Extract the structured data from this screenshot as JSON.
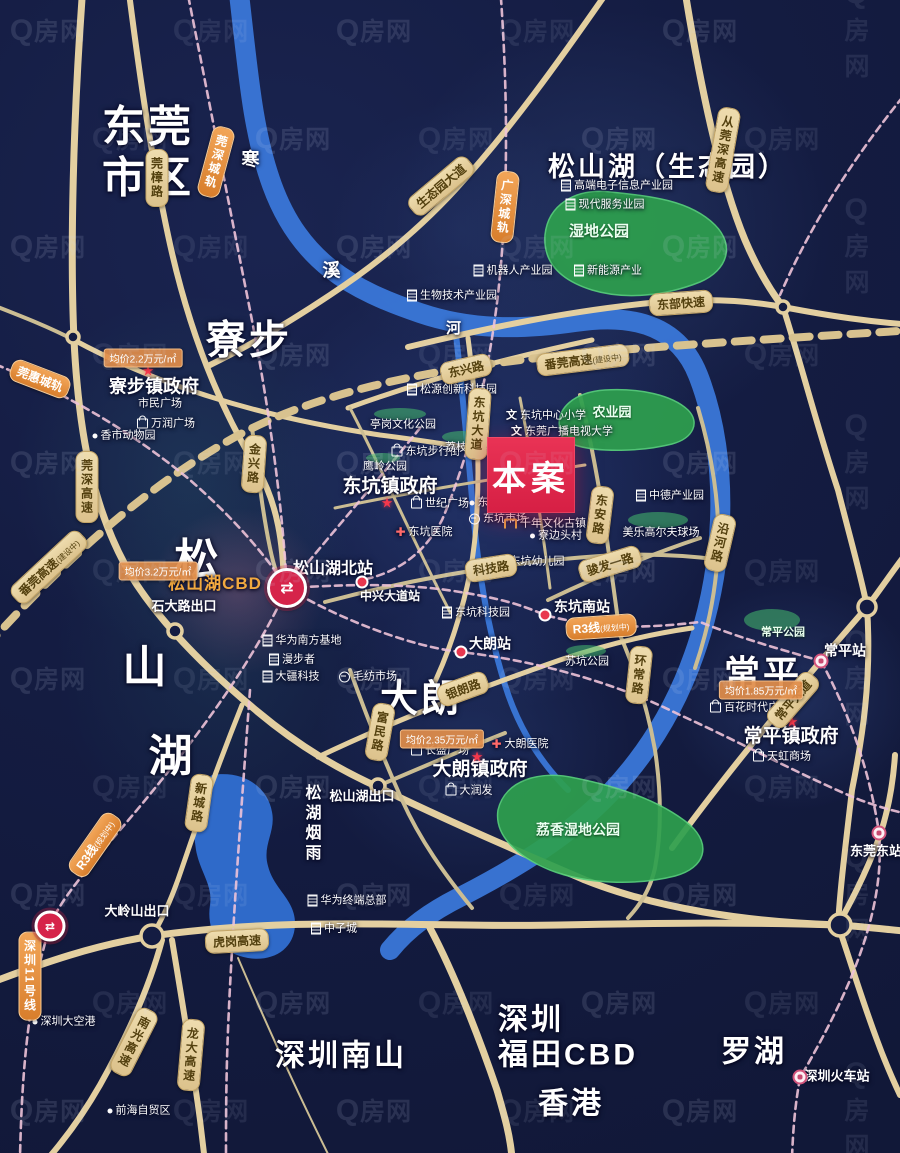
{
  "meta": {
    "width": 900,
    "height": 1153
  },
  "watermark": {
    "text": "Q房网"
  },
  "site": {
    "label": "本案",
    "x": 487,
    "y": 437,
    "w": 88,
    "h": 76,
    "color": "#e2264d"
  },
  "colors": {
    "background": "#141c42",
    "road": "#e3cfa0",
    "road_thin": "#cbbd93",
    "river": "#3a77d8",
    "rail_dash": "#eec3d8",
    "construction_dash": "#d8c28f",
    "park": "#2ea04e",
    "badge_road_bg": "#e8d3a2",
    "badge_rail_bg": "#e2903f",
    "accent_red": "#d6244a",
    "price_badge": "#e08d4a"
  },
  "geometry": {
    "rivers": [
      {
        "d": "M238,-15 C248,70 252,130 272,185 C300,262 352,290 420,313 C470,330 520,330 575,322 C640,312 680,330 698,375 C715,418 722,470 720,520 C718,565 710,610 694,655 C676,706 648,753 610,793 C570,835 520,866 462,896 C430,912 408,928 390,950",
        "w": 20
      },
      {
        "d": "M455,325 C462,390 468,450 473,510 C478,570 488,630 505,685 C518,727 540,762 568,790",
        "w": 6
      }
    ],
    "lake": "M212,775 C245,770 268,788 272,812 C276,832 262,845 268,866 C274,890 296,900 295,925 C294,950 272,962 248,958 C220,953 206,932 210,905 C213,885 200,872 196,850 C192,822 190,790 212,775 Z",
    "roads": [
      {
        "d": "M83,-15 C73,120 70,250 74,340 C79,440 95,520 137,585 C165,627 205,668 258,712 C300,747 340,770 380,788 C450,822 520,852 585,880 C655,908 745,922 838,925",
        "w": 7
      },
      {
        "d": "M430,928 C455,975 480,1040 497,1090 C505,1118 510,1135 512,1158",
        "w": 7
      },
      {
        "d": "M-15,985 C45,962 95,945 152,936 C300,915 430,928 560,925 C660,923 750,922 838,925 C870,927 890,930 915,932",
        "w": 7
      },
      {
        "d": "M838,925 C855,895 868,868 879,838 C888,812 893,785 895,755",
        "w": 6
      },
      {
        "d": "M838,925 C850,960 862,1000 877,1040 C885,1062 893,1080 900,1095",
        "w": 6
      },
      {
        "d": "M408,347 C480,330 560,312 650,303 C700,298 745,300 783,307 C830,316 870,322 915,325",
        "w": 6
      },
      {
        "d": "M684,-15 C700,85 720,180 745,240 C757,268 770,290 783,307",
        "w": 7
      },
      {
        "d": "M783,307 C800,360 818,430 838,490 C852,545 862,580 867,607 C872,680 862,740 852,790 C845,850 840,890 838,925",
        "w": 6
      },
      {
        "d": "M612,-15 C560,60 510,130 455,190 C420,228 380,262 330,295 C285,325 245,348 210,365",
        "w": 6
      },
      {
        "d": "M128,-15 C140,80 152,160 168,235 C186,320 215,400 258,470 C278,505 283,545 284,585",
        "w": 6
      },
      {
        "d": "M74,340 C170,392 280,420 380,435 C420,440 450,445 470,448",
        "w": 5
      },
      {
        "d": "M252,428 C258,470 262,510 270,548 C274,568 279,580 284,592",
        "w": 4
      },
      {
        "d": "M348,408 C420,382 490,362 592,340",
        "w": 5
      },
      {
        "d": "M468,338 C476,400 480,455 477,510 C475,555 468,590 455,630 C448,652 440,672 430,692",
        "w": 5
      },
      {
        "d": "M580,395 C592,445 600,490 607,540 C612,575 616,605 620,635",
        "w": 4
      },
      {
        "d": "M620,635 C636,672 648,710 655,750 C661,790 662,830 655,868 C650,890 640,905 628,918",
        "w": 4
      },
      {
        "d": "M698,408 C712,455 720,505 718,550 C716,590 708,630 695,668",
        "w": 4
      },
      {
        "d": "M325,602 C420,577 510,562 600,556 C645,553 685,555 722,560",
        "w": 4
      },
      {
        "d": "M548,600 C590,580 640,558 700,538",
        "w": 4
      },
      {
        "d": "M318,757 C400,718 480,688 560,660 C605,645 650,634 692,628",
        "w": 5
      },
      {
        "d": "M350,670 C366,715 382,755 402,800 C420,840 445,875 472,908",
        "w": 4
      },
      {
        "d": "M242,705 C220,760 200,815 182,868 C172,898 162,920 152,936",
        "w": 5
      },
      {
        "d": "M672,848 C725,775 795,690 867,607 C880,590 892,572 905,555",
        "w": 6
      },
      {
        "d": "M-15,302 C18,315 45,325 74,340",
        "w": 4
      },
      {
        "d": "M162,940 C150,985 128,1035 100,1085 C80,1120 60,1145 45,1162",
        "w": 6
      },
      {
        "d": "M172,940 C182,1000 192,1060 200,1120 L205,1162",
        "w": 6
      },
      {
        "d": "M378,786 C420,768 462,750 505,733",
        "w": 4
      },
      {
        "d": "M350,408 C385,475 415,545 450,612",
        "w": 3
      },
      {
        "d": "M335,508 C430,488 520,475 585,465",
        "w": 3
      },
      {
        "d": "M520,398 C532,460 542,525 550,588",
        "w": 3
      },
      {
        "d": "M238,958 C268,1028 300,1098 332,1162",
        "w": 2
      }
    ],
    "rails": [
      "M186,-15 C208,95 228,200 248,300 C268,400 282,500 287,588",
      "M287,588 C340,585 400,582 460,592 C510,600 528,608 545,615 C600,630 650,628 700,622 C745,640 790,652 821,661",
      "M821,661 C850,715 870,772 879,833 C886,915 845,1000 800,1078 C795,1105 793,1130 792,1158",
      "M420,428 C380,478 330,535 287,588",
      "M287,588 C250,670 180,760 120,830 C85,872 60,900 50,926 C30,990 22,1060 20,1158",
      "M500,-15 C508,90 508,190 500,275 C492,360 472,450 442,520 C425,552 400,572 362,580",
      "M287,588 C350,625 420,648 461,652 C530,660 610,680 680,715 C740,742 800,775 860,800 C880,807 895,812 915,815",
      "M250,690 C242,800 232,930 228,1030 C226,1080 226,1120 226,1158",
      "M-15,360 C60,390 130,430 190,480 C230,515 262,550 287,588",
      "M910,88 C855,155 812,222 780,295"
    ],
    "construction": "M-15,648 C60,565 140,490 235,437 C340,380 480,362 620,350 C720,342 820,336 915,330",
    "parks": [
      "M545,235 C548,205 575,188 610,192 C650,196 690,200 715,225 C735,245 728,270 700,282 C665,296 625,300 592,290 C560,280 543,262 545,235 Z",
      "M560,430 C555,408 575,392 605,390 C640,388 672,395 688,410 C700,422 694,438 672,444 C640,452 600,452 578,446 C563,442 562,438 560,430 Z",
      "M498,810 C505,780 540,770 575,778 C615,786 660,800 690,825 C712,845 705,868 675,876 C635,886 585,884 550,870 C518,857 494,836 498,810 Z"
    ],
    "smallParks": [
      {
        "x": 400,
        "y": 414,
        "rx": 26,
        "ry": 6
      },
      {
        "x": 462,
        "y": 437,
        "rx": 20,
        "ry": 6
      },
      {
        "x": 383,
        "y": 458,
        "rx": 17,
        "ry": 5
      },
      {
        "x": 586,
        "y": 651,
        "rx": 20,
        "ry": 6
      },
      {
        "x": 658,
        "y": 520,
        "rx": 30,
        "ry": 8
      },
      {
        "x": 772,
        "y": 620,
        "rx": 28,
        "ry": 11
      }
    ],
    "nodes": [
      {
        "x": 73,
        "y": 337,
        "r": 6
      },
      {
        "x": 175,
        "y": 631,
        "r": 7
      },
      {
        "x": 378,
        "y": 786,
        "r": 7
      },
      {
        "x": 152,
        "y": 936,
        "r": 11
      },
      {
        "x": 840,
        "y": 925,
        "r": 11
      },
      {
        "x": 867,
        "y": 607,
        "r": 9
      },
      {
        "x": 783,
        "y": 307,
        "r": 6
      }
    ]
  },
  "glows": [
    {
      "x": 395,
      "y": 10,
      "w": 440,
      "h": 430,
      "c": "rgba(80,120,185,0.20)"
    },
    {
      "x": 15,
      "y": 295,
      "w": 350,
      "h": 360,
      "c": "rgba(52,120,130,0.22)"
    },
    {
      "x": 250,
      "y": 265,
      "w": 480,
      "h": 445,
      "c": "rgba(72,112,205,0.26)"
    },
    {
      "x": 150,
      "y": 508,
      "w": 175,
      "h": 168,
      "c": "rgba(225,120,155,0.28)"
    },
    {
      "x": 315,
      "y": 598,
      "w": 315,
      "h": 290,
      "c": "rgba(70,112,195,0.20)"
    },
    {
      "x": 668,
      "y": 580,
      "w": 252,
      "h": 230,
      "c": "rgba(80,118,200,0.22)"
    },
    {
      "x": 55,
      "y": 470,
      "w": 330,
      "h": 380,
      "c": "rgba(42,100,112,0.20)"
    },
    {
      "x": 330,
      "y": 100,
      "w": 260,
      "h": 260,
      "c": "rgba(60,90,160,0.15)"
    }
  ],
  "areas": [
    {
      "t": "东莞\n市区",
      "x": 148,
      "y": 153,
      "fs": 43
    },
    {
      "t": "松山湖（生态园）",
      "x": 668,
      "y": 168,
      "fs": 27
    },
    {
      "t": "寮步",
      "x": 249,
      "y": 341,
      "fs": 40
    },
    {
      "t": "大朗",
      "x": 421,
      "y": 700,
      "fs": 38
    },
    {
      "t": "常平",
      "x": 763,
      "y": 674,
      "fs": 36
    },
    {
      "t": "松",
      "x": 198,
      "y": 561,
      "fs": 44
    },
    {
      "t": "山",
      "x": 146,
      "y": 668,
      "fs": 44
    },
    {
      "t": "湖",
      "x": 172,
      "y": 757,
      "fs": 44
    },
    {
      "t": "松湖烟雨",
      "x": 310,
      "y": 824,
      "fs": 16,
      "vert": true
    },
    {
      "t": "寒",
      "x": 252,
      "y": 160,
      "fs": 18
    },
    {
      "t": "溪",
      "x": 333,
      "y": 271,
      "fs": 18
    },
    {
      "t": "河",
      "x": 455,
      "y": 329,
      "fs": 15
    },
    {
      "t": "深圳南山",
      "x": 341,
      "y": 1056,
      "fs": 30
    },
    {
      "t": "深圳\n福田CBD",
      "x": 568,
      "y": 1038,
      "fs": 30
    },
    {
      "t": "香港",
      "x": 571,
      "y": 1104,
      "fs": 30
    },
    {
      "t": "罗湖",
      "x": 754,
      "y": 1052,
      "fs": 30
    }
  ],
  "governments": [
    {
      "t": "寮步镇政府",
      "x": 154,
      "y": 387,
      "fs": 18,
      "sx": 148,
      "sy": 371
    },
    {
      "t": "东坑镇政府",
      "x": 390,
      "y": 487,
      "fs": 19,
      "sx": 387,
      "sy": 503
    },
    {
      "t": "大朗镇政府",
      "x": 480,
      "y": 770,
      "fs": 19,
      "sx": 477,
      "sy": 757
    },
    {
      "t": "常平镇政府",
      "x": 791,
      "y": 737,
      "fs": 19,
      "sx": 792,
      "sy": 722
    }
  ],
  "stations": [
    {
      "t": "松山湖北站",
      "x": 333,
      "y": 570,
      "fs": 16
    },
    {
      "t": "中兴大道站",
      "x": 390,
      "y": 596,
      "fs": 12
    },
    {
      "t": "东坑南站",
      "x": 582,
      "y": 607,
      "fs": 14
    },
    {
      "t": "大朗站",
      "x": 490,
      "y": 644,
      "fs": 14
    },
    {
      "t": "常平站",
      "x": 845,
      "y": 651,
      "fs": 14
    },
    {
      "t": "东莞东站",
      "x": 876,
      "y": 851,
      "fs": 13
    },
    {
      "t": "深圳火车站",
      "x": 837,
      "y": 1076,
      "fs": 13
    }
  ],
  "exits": [
    {
      "t": "石大路出口",
      "x": 184,
      "y": 606
    },
    {
      "t": "大岭山出口",
      "x": 137,
      "y": 911
    },
    {
      "t": "松山湖出口",
      "x": 362,
      "y": 796
    }
  ],
  "special": [
    {
      "t": "松山湖CBD",
      "x": 215,
      "y": 584
    }
  ],
  "pois": [
    {
      "t": "高端电子信息产业园",
      "x": 617,
      "y": 186,
      "icon": "bldg"
    },
    {
      "t": "现代服务业园",
      "x": 605,
      "y": 205,
      "icon": "bldg"
    },
    {
      "t": "机器人产业园",
      "x": 513,
      "y": 271,
      "icon": "bldg"
    },
    {
      "t": "新能源产业",
      "x": 608,
      "y": 271,
      "icon": "bldg"
    },
    {
      "t": "生物技术产业园",
      "x": 452,
      "y": 296,
      "icon": "bldg"
    },
    {
      "t": "松源创新科技园",
      "x": 452,
      "y": 390,
      "icon": "bldg"
    },
    {
      "t": "东坑中心小学",
      "x": 546,
      "y": 416,
      "icon": "school"
    },
    {
      "t": "东莞广播电视大学",
      "x": 562,
      "y": 432,
      "icon": "school"
    },
    {
      "t": "亭岗文化公园",
      "x": 403,
      "y": 425
    },
    {
      "t": "东坑步行街",
      "x": 426,
      "y": 452,
      "icon": "bag"
    },
    {
      "t": "荔枝公园",
      "x": 467,
      "y": 448
    },
    {
      "t": "鹰岭公园",
      "x": 385,
      "y": 467
    },
    {
      "t": "世纪广场",
      "x": 440,
      "y": 504,
      "icon": "bag"
    },
    {
      "t": "东坑村",
      "x": 490,
      "y": 503,
      "icon": "dot"
    },
    {
      "t": "东坑市场",
      "x": 498,
      "y": 519,
      "icon": "market"
    },
    {
      "t": "东坑医院",
      "x": 424,
      "y": 532,
      "icon": "cross"
    },
    {
      "t": "千年文化古镇",
      "x": 545,
      "y": 524,
      "icon": "arch"
    },
    {
      "t": "寮边头村",
      "x": 556,
      "y": 536,
      "icon": "dot"
    },
    {
      "t": "东坑幼儿园",
      "x": 530,
      "y": 562,
      "icon": "school"
    },
    {
      "t": "东坑科技园",
      "x": 476,
      "y": 613,
      "icon": "bldg"
    },
    {
      "t": "中德产业园",
      "x": 670,
      "y": 496,
      "icon": "bldg"
    },
    {
      "t": "美乐高尔夫球场",
      "x": 661,
      "y": 533
    },
    {
      "t": "苏坑公园",
      "x": 587,
      "y": 662
    },
    {
      "t": "市民广场",
      "x": 160,
      "y": 404
    },
    {
      "t": "万润广场",
      "x": 166,
      "y": 424,
      "icon": "bag"
    },
    {
      "t": "香市动物园",
      "x": 124,
      "y": 436,
      "icon": "dot"
    },
    {
      "t": "华为南方基地",
      "x": 302,
      "y": 641,
      "icon": "bldg"
    },
    {
      "t": "漫步者",
      "x": 292,
      "y": 660,
      "icon": "bldg"
    },
    {
      "t": "大疆科技",
      "x": 291,
      "y": 677,
      "icon": "bldg"
    },
    {
      "t": "毛纺市场",
      "x": 368,
      "y": 677,
      "icon": "market"
    },
    {
      "t": "长盛广场",
      "x": 440,
      "y": 751,
      "icon": "bag"
    },
    {
      "t": "大朗医院",
      "x": 520,
      "y": 744,
      "icon": "cross"
    },
    {
      "t": "大润发",
      "x": 469,
      "y": 791,
      "icon": "bag"
    },
    {
      "t": "百花时代广场",
      "x": 750,
      "y": 708,
      "icon": "bag"
    },
    {
      "t": "天虹商场",
      "x": 782,
      "y": 757,
      "icon": "bag"
    },
    {
      "t": "华为终端总部",
      "x": 347,
      "y": 901,
      "icon": "bldg"
    },
    {
      "t": "中子城",
      "x": 334,
      "y": 929,
      "icon": "bldg"
    },
    {
      "t": "深圳大空港",
      "x": 64,
      "y": 1022,
      "icon": "dot"
    },
    {
      "t": "前海自贸区",
      "x": 139,
      "y": 1111,
      "icon": "dot"
    }
  ],
  "parkLabels": [
    {
      "t": "湿地公园",
      "x": 599,
      "y": 232,
      "fs": 15
    },
    {
      "t": "农业园",
      "x": 612,
      "y": 412,
      "fs": 13
    },
    {
      "t": "荔香湿地公园",
      "x": 578,
      "y": 830,
      "fs": 14
    },
    {
      "t": "常平公园",
      "x": 783,
      "y": 633,
      "fs": 11
    }
  ],
  "roadBadges": [
    {
      "t": "莞樟路",
      "x": 157,
      "y": 178,
      "vert": true
    },
    {
      "t": "生态园大道",
      "x": 441,
      "y": 186,
      "rot": -40
    },
    {
      "t": "东部快速",
      "x": 681,
      "y": 303,
      "rot": -4
    },
    {
      "t": "从莞深高速",
      "x": 723,
      "y": 150,
      "vert": true,
      "rot": 10
    },
    {
      "t": "莞深高速",
      "x": 87,
      "y": 487,
      "vert": true
    },
    {
      "t": "金兴路",
      "x": 254,
      "y": 464,
      "vert": true,
      "rot": 4
    },
    {
      "t": "东兴路",
      "x": 466,
      "y": 369,
      "rot": -13
    },
    {
      "t": "东坑大道",
      "x": 478,
      "y": 424,
      "vert": true,
      "rot": 4
    },
    {
      "t": "东安路",
      "x": 600,
      "y": 515,
      "vert": true,
      "rot": 7
    },
    {
      "t": "沿河路",
      "x": 720,
      "y": 543,
      "vert": true,
      "rot": 13
    },
    {
      "t": "科技路",
      "x": 491,
      "y": 568,
      "rot": -9
    },
    {
      "t": "骏发一路",
      "x": 610,
      "y": 564,
      "rot": -17
    },
    {
      "t": "环常路",
      "x": 639,
      "y": 675,
      "vert": true,
      "rot": 6
    },
    {
      "t": "银朗路",
      "x": 463,
      "y": 689,
      "rot": -20
    },
    {
      "t": "富民路",
      "x": 380,
      "y": 732,
      "vert": true,
      "rot": 10
    },
    {
      "t": "常平大道",
      "x": 793,
      "y": 700,
      "rot": -49
    },
    {
      "t": "新城路",
      "x": 199,
      "y": 803,
      "vert": true,
      "rot": 8
    },
    {
      "t": "虎岗高速",
      "x": 237,
      "y": 941,
      "rot": -3
    },
    {
      "t": "南光高速",
      "x": 134,
      "y": 1042,
      "vert": true,
      "rot": 27
    },
    {
      "t": "龙大高速",
      "x": 191,
      "y": 1055,
      "vert": true,
      "rot": 5
    },
    {
      "t": "番莞高速",
      "s": "(建设中)",
      "x": 49,
      "y": 567,
      "rot": -43
    },
    {
      "t": "番莞高速",
      "s": "(建设中)",
      "x": 583,
      "y": 360,
      "rot": -7
    }
  ],
  "railBadges": [
    {
      "t": "莞深城轨",
      "x": 216,
      "y": 162,
      "vert": true,
      "rot": 15
    },
    {
      "t": "广深城轨",
      "x": 505,
      "y": 207,
      "vert": true,
      "rot": 6
    },
    {
      "t": "莞惠城轨",
      "x": 40,
      "y": 379,
      "rot": 21
    },
    {
      "t": "R3线",
      "s": "(规划中)",
      "x": 601,
      "y": 627,
      "rot": -4
    },
    {
      "t": "R3线",
      "s": "(规划中)",
      "x": 95,
      "y": 845,
      "rot": -55
    },
    {
      "t": "深圳11号线",
      "x": 30,
      "y": 976,
      "vert": true
    }
  ],
  "priceBadges": [
    {
      "t": "均价2.2万元/㎡",
      "x": 143,
      "y": 358
    },
    {
      "t": "均价3.2万元/㎡",
      "x": 158,
      "y": 571
    },
    {
      "t": "均价2.35万元/㎡",
      "x": 442,
      "y": 739
    },
    {
      "t": "均价1.85万元/㎡",
      "x": 761,
      "y": 690
    }
  ],
  "interchanges": [
    {
      "x": 287,
      "y": 588,
      "size": 34,
      "glyph": "⇄"
    },
    {
      "x": 50,
      "y": 926,
      "size": 25,
      "glyph": "⇄"
    }
  ],
  "trainIcons": [
    {
      "x": 821,
      "y": 661
    },
    {
      "x": 879,
      "y": 833
    },
    {
      "x": 800,
      "y": 1077
    }
  ],
  "railDots": [
    {
      "x": 362,
      "y": 582
    },
    {
      "x": 545,
      "y": 615
    },
    {
      "x": 461,
      "y": 652
    }
  ]
}
